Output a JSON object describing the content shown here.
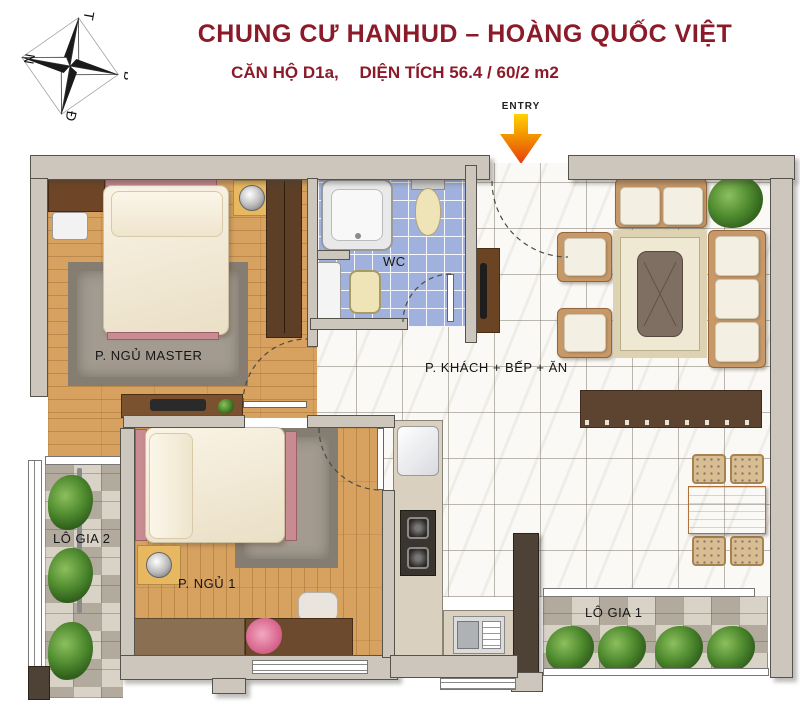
{
  "header": {
    "title": "CHUNG CƯ HANHUD – HOÀNG QUỐC VIỆT",
    "subtitle_unit": "CĂN HỘ D1a,",
    "subtitle_area": "DIỆN TÍCH  56.4 / 60/2 m2"
  },
  "entry": {
    "label": "ENTRY"
  },
  "compass": {
    "top": "T",
    "right": "B",
    "bottom": "Đ",
    "left": "N"
  },
  "rooms": {
    "master_bedroom": {
      "label": "P. NGỦ MASTER"
    },
    "wc": {
      "label": "WC"
    },
    "living_kitchen": {
      "label": "P. KHÁCH + BẾP + ĂN"
    },
    "bedroom_1": {
      "label": "P. NGỦ 1"
    },
    "loggia_1": {
      "label": "LÔ GIA 1"
    },
    "loggia_2": {
      "label": "LÔ GIA 2"
    }
  },
  "colors": {
    "title_red": "#8c1b2a",
    "wall_grey": "#ccc6bd",
    "wood_floor": "#d7a25f",
    "wc_tile_blue": "#9fb1dc",
    "marble_white": "#faf9f6",
    "granite_grey": "#c8c1b5",
    "entry_arrow_orange": "#f07818"
  }
}
